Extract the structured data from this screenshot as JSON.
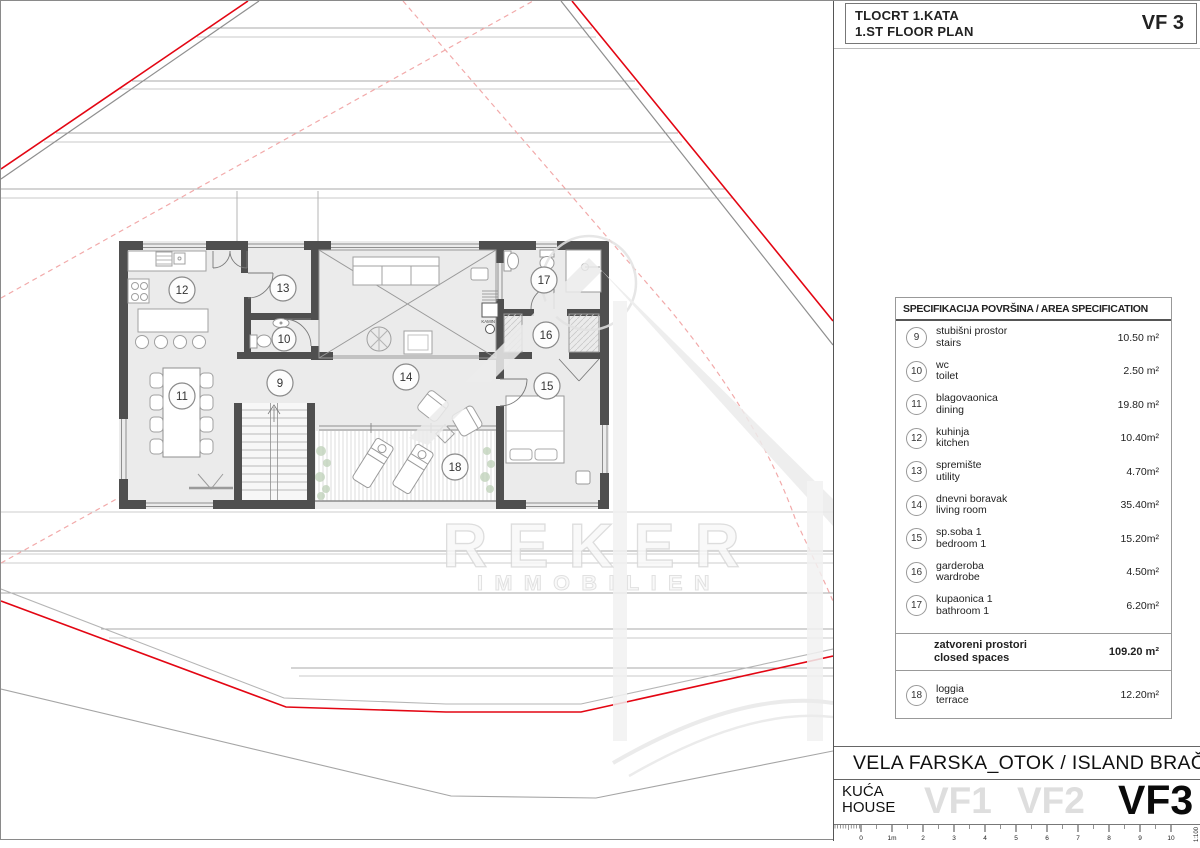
{
  "title_block": {
    "line1": "TLOCRT 1.KATA",
    "line2": "1.ST FLOOR PLAN",
    "code": "VF 3"
  },
  "watermark": {
    "line1": "REKER",
    "line2": "IMMOBILIEN"
  },
  "plan": {
    "kamin_label": "KAMIN"
  },
  "spec_table": {
    "title": "SPECIFIKACIJA POVRŠINA / AREA SPECIFICATION",
    "rows": [
      {
        "num": "9",
        "name_hr": "stubišni prostor",
        "name_en": "stairs",
        "area": "10.50 m²"
      },
      {
        "num": "10",
        "name_hr": "wc",
        "name_en": "toilet",
        "area": "2.50 m²"
      },
      {
        "num": "11",
        "name_hr": "blagovaonica",
        "name_en": "dining",
        "area": "19.80 m²"
      },
      {
        "num": "12",
        "name_hr": "kuhinja",
        "name_en": "kitchen",
        "area": "10.40m²"
      },
      {
        "num": "13",
        "name_hr": "spremište",
        "name_en": "utility",
        "area": "4.70m²"
      },
      {
        "num": "14",
        "name_hr": "dnevni boravak",
        "name_en": "living room",
        "area": "35.40m²"
      },
      {
        "num": "15",
        "name_hr": "sp.soba 1",
        "name_en": "bedroom 1",
        "area": "15.20m²"
      },
      {
        "num": "16",
        "name_hr": "garderoba",
        "name_en": "wardrobe",
        "area": "4.50m²"
      },
      {
        "num": "17",
        "name_hr": "kupaonica 1",
        "name_en": "bathroom 1",
        "area": "6.20m²"
      }
    ],
    "summary": {
      "name_hr": "zatvoreni prostori",
      "name_en": "closed spaces",
      "area": "109.20 m²"
    },
    "extra_rows": [
      {
        "num": "18",
        "name_hr": "loggia",
        "name_en": "terrace",
        "area": "12.20m²"
      }
    ]
  },
  "footer": {
    "project": "VELA FARSKA_OTOK / ISLAND BRAČ",
    "label_hr": "KUĆA",
    "label_en": "HOUSE",
    "ghost_variants": [
      "VF1",
      "VF2"
    ],
    "active_variant": "VF3"
  },
  "scale_bar": {
    "ticks": [
      "0",
      "1m",
      "2",
      "3",
      "4",
      "5",
      "6",
      "7",
      "8",
      "9",
      "10"
    ],
    "ratio": "1:100"
  },
  "colors": {
    "boundary_red": "#e30613",
    "dashed_pink": "#f2aaaa",
    "wall": "#4f4f4f",
    "ghost_text": "#dedede"
  }
}
